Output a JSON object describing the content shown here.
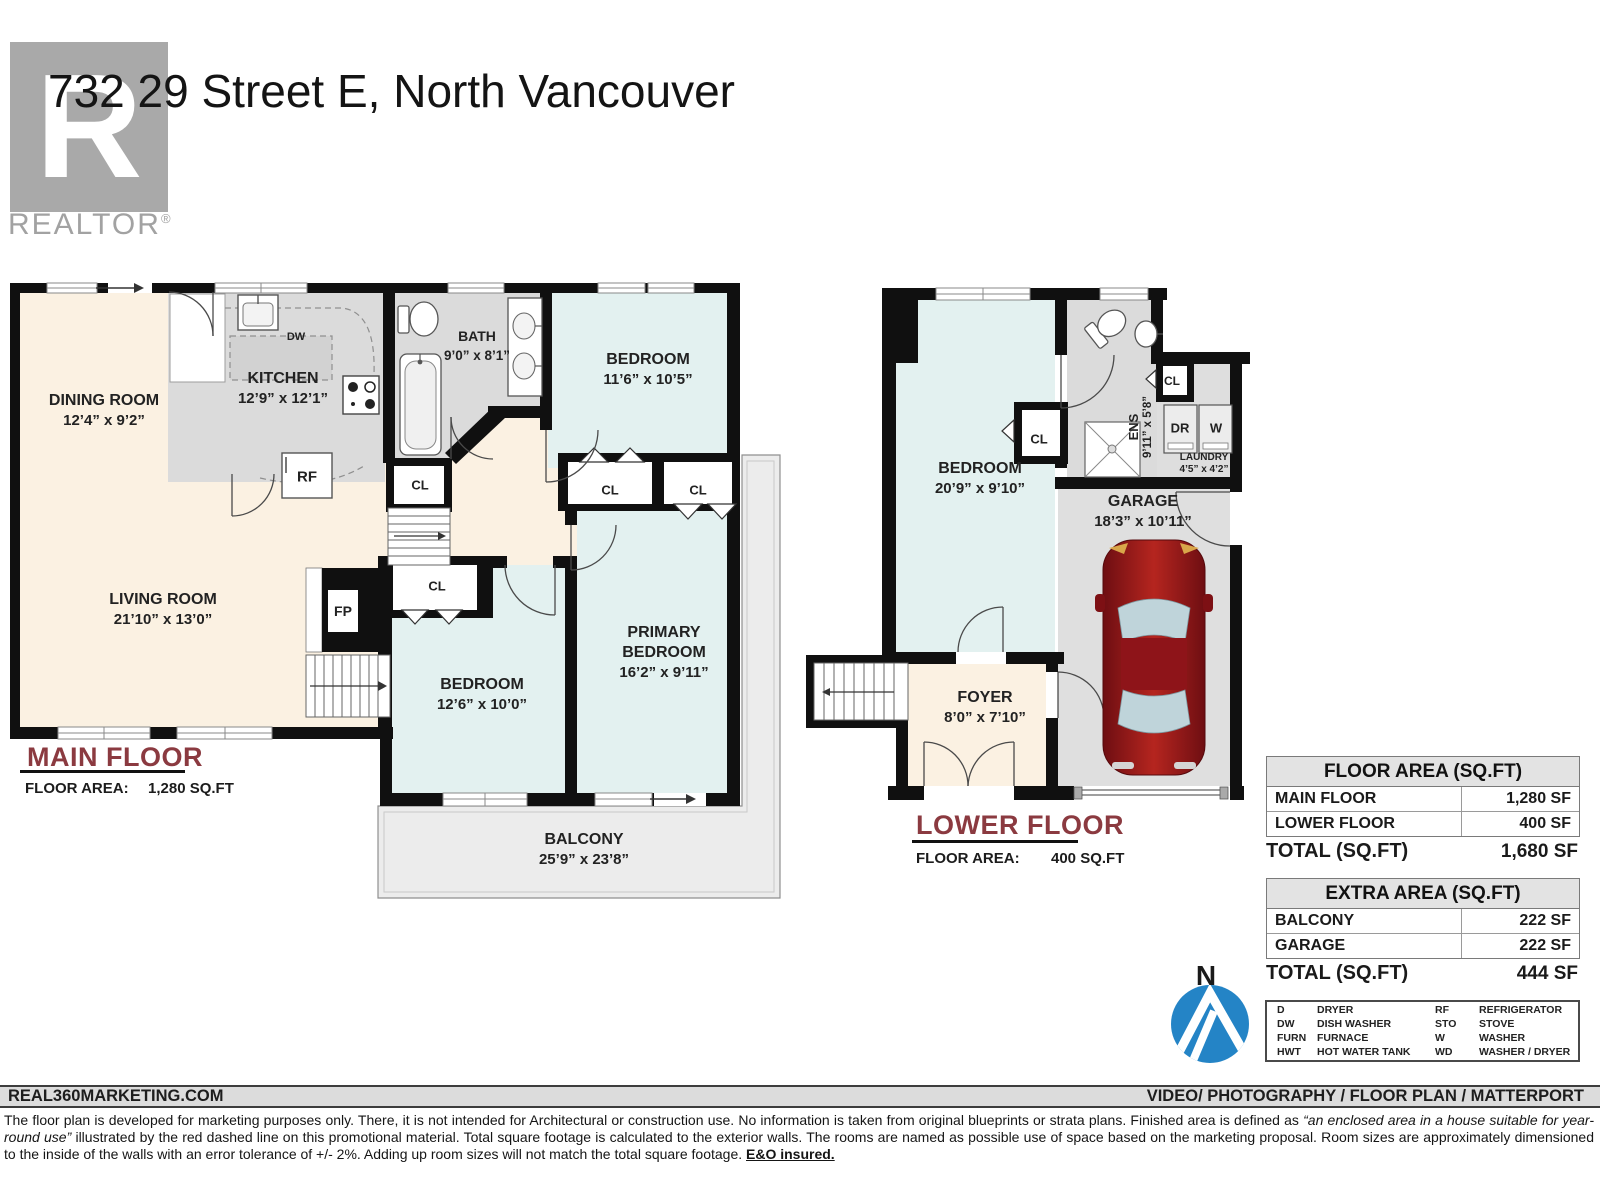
{
  "header": {
    "title": "732 29 Street E, North Vancouver",
    "logo_letter": "R",
    "brand": "REALTOR",
    "brand_reg": "®"
  },
  "plans": {
    "main": {
      "title": "MAIN FLOOR",
      "area_label": "FLOOR AREA:",
      "area_value": "1,280 SQ.FT",
      "rooms": {
        "dining": {
          "name": "DINING ROOM",
          "dims": "12’4” x 9’2”"
        },
        "kitchen": {
          "name": "KITCHEN",
          "dims": "12’9” x 12’1”"
        },
        "bath": {
          "name": "BATH",
          "dims": "9’0” x 8’1”"
        },
        "bedroom1": {
          "name": "BEDROOM",
          "dims": "11’6” x 10’5”"
        },
        "living": {
          "name": "LIVING ROOM",
          "dims": "21’10” x 13’0”"
        },
        "bedroom2": {
          "name": "BEDROOM",
          "dims": "12’6” x 10’0”"
        },
        "primary": {
          "name1": "PRIMARY",
          "name2": "BEDROOM",
          "dims": "16’2” x 9’11”"
        },
        "balcony": {
          "name": "BALCONY",
          "dims": "25’9” x 23’8”"
        }
      },
      "fixtures": {
        "dw": "DW",
        "rf": "RF",
        "fp": "FP",
        "cl": "CL"
      }
    },
    "lower": {
      "title": "LOWER FLOOR",
      "area_label": "FLOOR AREA:",
      "area_value": "400 SQ.FT",
      "rooms": {
        "bedroom": {
          "name": "BEDROOM",
          "dims": "20’9” x 9’10”"
        },
        "ens": {
          "name": "ENS",
          "dims": "9’11” x 5’8”"
        },
        "laundry": {
          "name": "LAUNDRY",
          "dims": "4’5” x 4’2”"
        },
        "garage": {
          "name": "GARAGE",
          "dims": "18’3” x 10’11”"
        },
        "foyer": {
          "name": "FOYER",
          "dims": "8’0” x 7’10”"
        }
      },
      "fixtures": {
        "dr": "DR",
        "w": "W",
        "cl": "CL"
      }
    }
  },
  "area_table": {
    "title": "FLOOR AREA (SQ.FT)",
    "rows": [
      {
        "label": "MAIN FLOOR",
        "value": "1,280 SF"
      },
      {
        "label": "LOWER FLOOR",
        "value": "400 SF"
      }
    ],
    "total_label": "TOTAL (SQ.FT)",
    "total_value": "1,680 SF"
  },
  "extra_table": {
    "title": "EXTRA AREA (SQ.FT)",
    "rows": [
      {
        "label": "BALCONY",
        "value": "222 SF"
      },
      {
        "label": "GARAGE",
        "value": "222 SF"
      }
    ],
    "total_label": "TOTAL (SQ.FT)",
    "total_value": "444 SF"
  },
  "legend": {
    "col1": [
      {
        "abbr": "D",
        "name": "DRYER"
      },
      {
        "abbr": "DW",
        "name": "DISH WASHER"
      },
      {
        "abbr": "FURN",
        "name": "FURNACE"
      },
      {
        "abbr": "HWT",
        "name": "HOT WATER TANK"
      }
    ],
    "col2": [
      {
        "abbr": "RF",
        "name": "REFRIGERATOR"
      },
      {
        "abbr": "STO",
        "name": "STOVE"
      },
      {
        "abbr": "W",
        "name": "WASHER"
      },
      {
        "abbr": "WD",
        "name": "WASHER / DRYER"
      }
    ]
  },
  "compass": {
    "label": "N"
  },
  "footer": {
    "left": "REAL360MARKETING.COM",
    "right": "VIDEO/ PHOTOGRAPHY / FLOOR PLAN / MATTERPORT"
  },
  "disclaimer": {
    "part1": "The floor plan is developed for marketing purposes only. There, it is not intended for Architectural or construction use. No information is  taken from original blueprints or strata plans. Finished area is defined as  ",
    "italic": "“an enclosed area in a house suitable for year-round use”",
    "part2": " illustrated by the red dashed line on this promotional material. Total square footage is calculated to the exterior walls. The rooms are named as possible use of space based on the marketing proposal. Room sizes are approximately dimensioned to the inside of the walls with an error tolerance of +/- 2%. Adding up room sizes will not match the total square footage. ",
    "bold": "E&O insured."
  },
  "colors": {
    "accent_maroon": "#8b3a40",
    "compass_blue": "#2484c6",
    "car_red": "#9c1a1f"
  }
}
